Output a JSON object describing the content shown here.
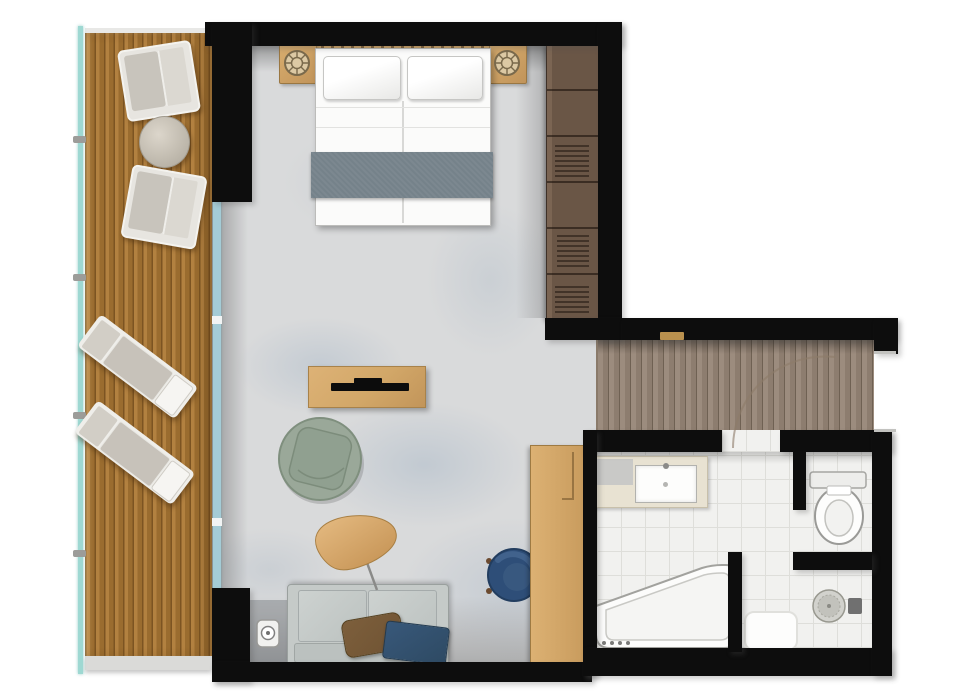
{
  "meta": {
    "type": "floor-plan",
    "description": "Top-down rendered floor plan of a hotel suite: wooden balcony with loungers, bedroom and living area, entrance hallway and bathroom with separate WC and shower"
  },
  "rooms": {
    "balcony": {
      "label": "Balcony"
    },
    "living": {
      "label": "Bedroom & Living Area"
    },
    "hallway": {
      "label": "Entrance Hallway"
    },
    "bathroom": {
      "label": "Bathroom"
    },
    "wc": {
      "label": "WC"
    },
    "shower": {
      "label": "Shower"
    }
  },
  "furniture": {
    "deckchair": "Outdoor armchair",
    "decktable": "Outdoor side table",
    "lounger": "Sun lounger",
    "bed": "Double bed",
    "headboard": "Headboard",
    "nightstand": "Nightstand with lamp",
    "wardrobe": "Wardrobe",
    "console": "TV console",
    "tv": "Television",
    "armchair": "Round lounge chair",
    "lamp": "Floor lamp",
    "sofa": "Sofa with cushions",
    "desk": "Desk",
    "deskchair": "Desk chair",
    "vanity": "Vanity with sink",
    "tub": "Bathtub",
    "toilet": "Toilet",
    "drain": "Shower drain",
    "mat": "Bath mat",
    "door": "Door swing",
    "railing": "Glass railing",
    "glasswall": "Sliding glass door"
  },
  "colors": {
    "wall": "#0d0d0d",
    "deck_a": "#b28140",
    "deck_b": "#9a6c2f",
    "deck_line": "#7c5422",
    "fascia": "#dadad8",
    "railing": "#9ed8d2",
    "carpet": "#d9dadb",
    "glass": "#a4ccd6",
    "hall_a": "#9c8c7e",
    "hall_b": "#8d7d6f",
    "hall_line": "#6f6153",
    "wardrobe": "#6a5646",
    "wardrobe_hi": "#7b6553",
    "tile": "#f1f1ef",
    "grout": "#dededa",
    "wood": "#d2a768",
    "sofa": "#c5cac8",
    "runner": "#75828a",
    "green": "#9aa899",
    "navy": "#2e4a63",
    "chair_navy": "#2e4e78",
    "brown": "#6f5333",
    "cream": "#e8e2d2",
    "brass": "#b9904e"
  }
}
